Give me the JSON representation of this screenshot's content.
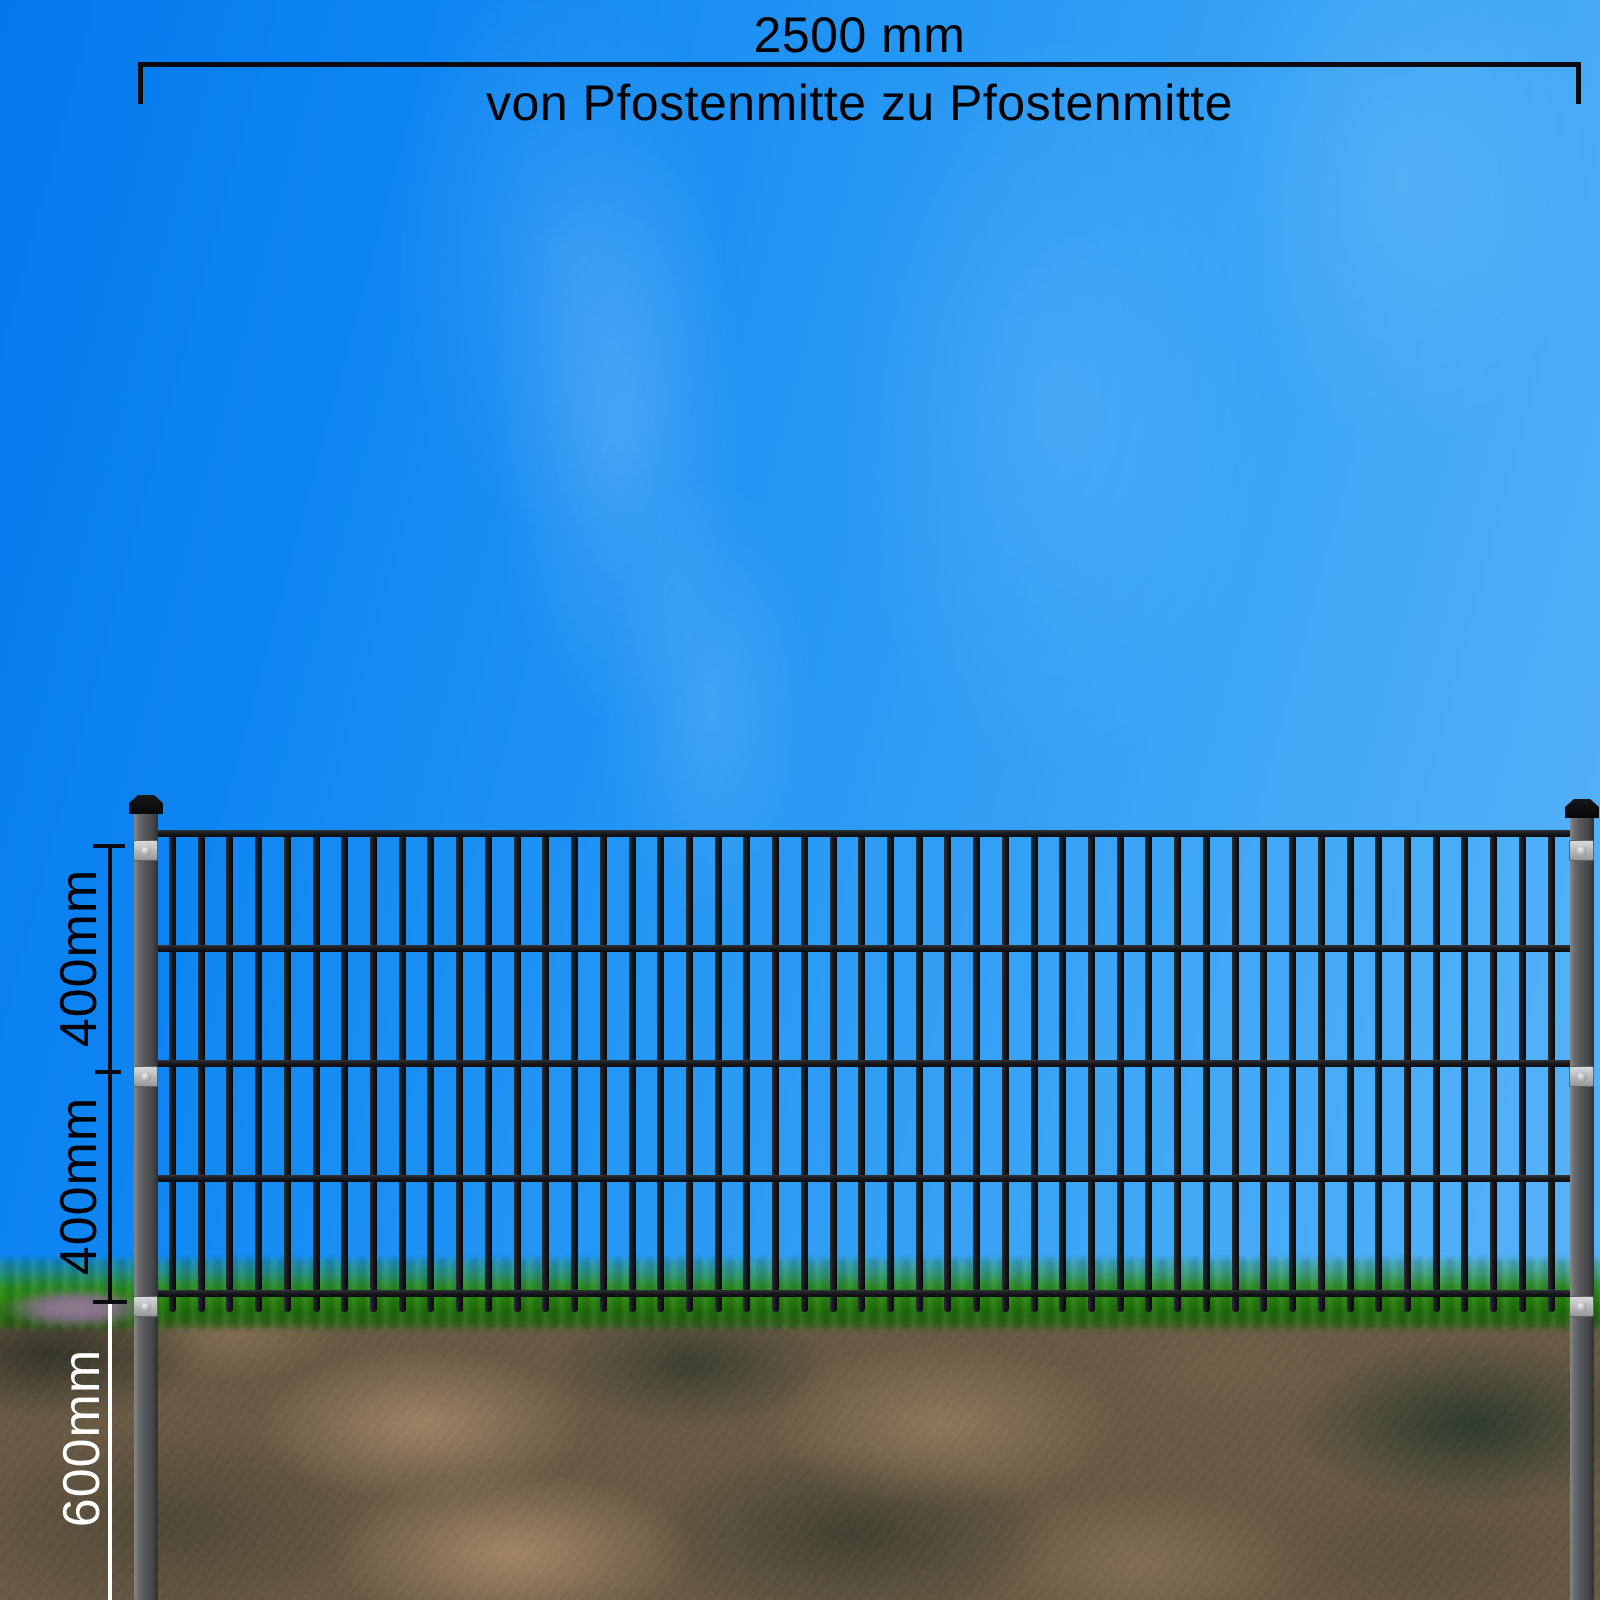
{
  "dimensions": {
    "top": {
      "value": "2500 mm",
      "caption": "von Pfostenmitte zu Pfostenmitte"
    },
    "left": {
      "upper": "400mm",
      "lower": "400mm",
      "underground": "600mm"
    }
  },
  "fence": {
    "bar_count": 49,
    "rail_count": 5,
    "post_count": 2,
    "plates_per_post": 3
  },
  "colors": {
    "sky_top_left": "#0377ec",
    "sky_bottom_right": "#5cb5f8",
    "grass": "#2c8412",
    "soil": "#6a5a43",
    "metal_dark": "#101114",
    "post_gray": "#55575a",
    "plate_gray": "#b5b6b8",
    "dim_text_dark": "#000000",
    "dim_text_light": "#ffffff"
  }
}
